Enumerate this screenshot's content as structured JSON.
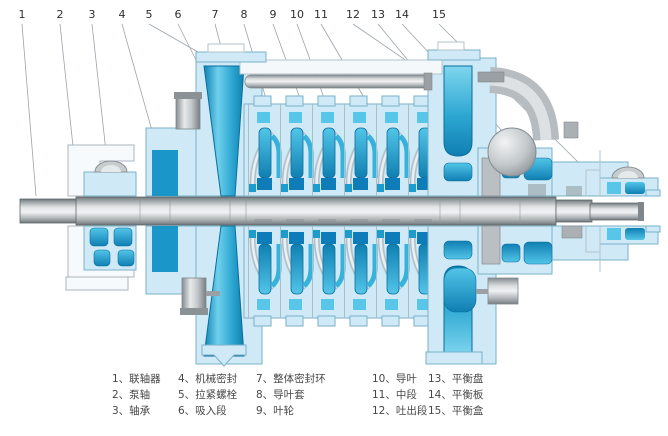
{
  "figure": {
    "kind": "technical cross-section diagram",
    "subject": "horizontal multistage centrifugal pump"
  },
  "colors": {
    "casing_light": "#cfeaf6",
    "casing_stroke": "#7ab2ca",
    "flow_dark_cyan": "#1181b4",
    "flow_mid_cyan": "#36b2dc",
    "deep_blue": "#0e7cb8",
    "metal_gray": "#b8bec2",
    "background": "#ffffff"
  },
  "callouts": {
    "numbers": [
      "1",
      "2",
      "3",
      "4",
      "5",
      "6",
      "7",
      "8",
      "9",
      "10",
      "11",
      "12",
      "13",
      "14",
      "15"
    ]
  },
  "legend": {
    "columns": [
      [
        "1、联轴器",
        "2、泵轴",
        "3、轴承"
      ],
      [
        "4、机械密封",
        "5、拉紧螺栓",
        "6、吸入段"
      ],
      [
        "7、整体密封环",
        "8、导叶套",
        "9、叶轮"
      ],
      [
        "10、导叶",
        "11、中段",
        "12、吐出段"
      ],
      [
        "13、平衡盘",
        "14、平衡板",
        "15、平衡盒"
      ]
    ]
  }
}
